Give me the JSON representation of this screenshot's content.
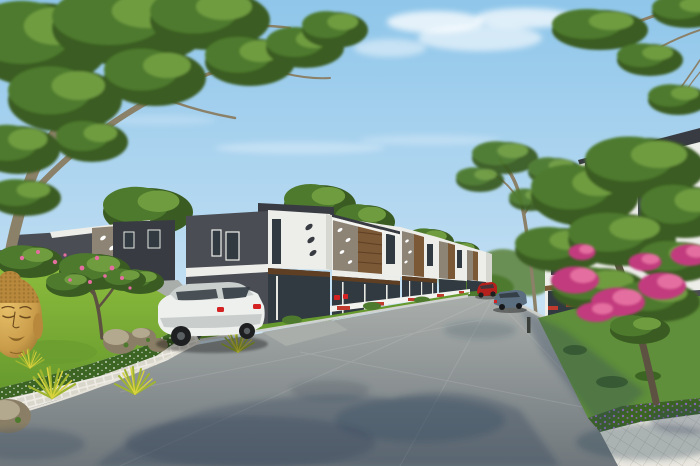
{
  "scene": {
    "type": "3d-architectural-render",
    "description": "Sunny 3D render of a residential street: a receding row of modern two-storey grey townhouses with white accent boxes, leaf-shaped cutouts and wood-slat balconies on the left; a white villa behind a large pink-flowering tree on the right; a landscaped garden island with a golden Buddha head statue, rocks and spiky plants in the left foreground; a white sedan, a blue sedan and a red hatchback parked along the asphalt street under dappled tree shadows; large trees frame a pale blue sky.",
    "objects": [
      "sky",
      "clouds",
      "left-tree",
      "background-houses",
      "townhouse-row",
      "street",
      "sidewalk-pavers",
      "garden-island",
      "buddha-statue",
      "rocks",
      "spiky-plants",
      "plumeria-tree",
      "white-sedan",
      "blue-sedan",
      "red-hatchback",
      "right-villa",
      "flowering-tree",
      "lawn",
      "purple-flower-hedge",
      "paver-walkway"
    ]
  },
  "palette": {
    "sky-top": "#8fc6ea",
    "sky-mid": "#bcdcf2",
    "sky-horizon": "#eaf4fa",
    "cloud": "#ffffff",
    "foliage-dark": "#3a5c22",
    "foliage-mid": "#4e7a2e",
    "foliage-light": "#6f9c3f",
    "foliage-bright": "#8ab84a",
    "foliage-distant": "#6a8f55",
    "trunk": "#8b8068",
    "trunk-dark": "#5d5242",
    "wall-dark": "#4a4e54",
    "wall-darker": "#383c42",
    "wall-white": "#edeeea",
    "wall-shade": "#d7d7d2",
    "panel-taupe": "#8d8476",
    "wood": "#7b5836",
    "wood-dark": "#5e3f24",
    "glass": "#313a41",
    "road-light": "#a9aeab",
    "road-dark": "#6f777c",
    "shadow-blue": "#2e4258",
    "curb": "#d8d6cd",
    "paver": "#d9d6cc",
    "paver-line": "#efede5",
    "paver-base": "#c6c3b8",
    "diamond": "#e9e7df",
    "diamond-line": "#c9c7bd",
    "grass-bright": "#8fbf3e",
    "grass-deep": "#679a2e",
    "lawn": "#5f8f3a",
    "hedge": "#3c6423",
    "buddha-gold": "#c99c4a",
    "buddha-cap": "#b8893c",
    "buddha-shadow": "#8a6426",
    "buddha-line": "#6b4a1c",
    "flower-pink": "#e56ea0",
    "flower-magenta": "#c23a7e",
    "flower-purple": "#8f6bbf",
    "car-white": "#eef0ee",
    "car-white-shade": "#c9cfcd",
    "car-blue": "#5a6e80",
    "car-red": "#b5201d",
    "accent-red": "#c03a2e",
    "tail-red": "#d42222",
    "rock": "#8a7f66",
    "rock-light": "#b3a98e"
  }
}
